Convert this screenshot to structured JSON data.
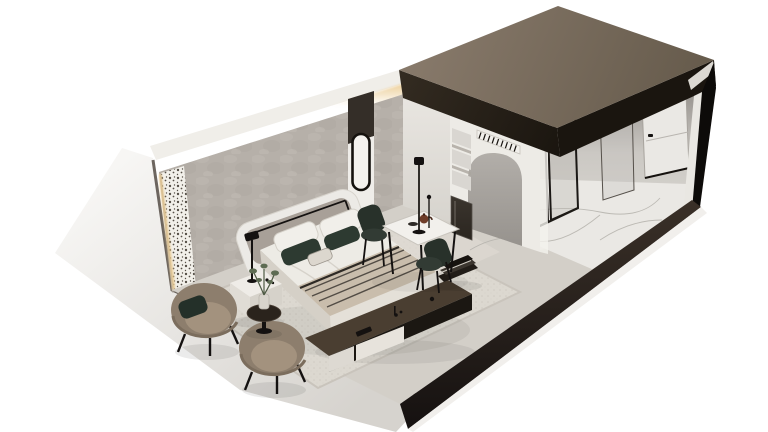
{
  "scene": {
    "kind": "isometric-3d-interior-render",
    "rooms": [
      "bedroom-lounge",
      "dining-nook",
      "entry-corridor",
      "bathroom"
    ],
    "objects": [
      "roof-slab",
      "left-outer-wall",
      "back-wall-wallpaper",
      "led-cove-light",
      "laser-cut-pattern-strip",
      "pilaster-oval-mirror",
      "arched-niche",
      "open-shelving-unit",
      "mini-fridge",
      "vent-grille",
      "double-bed",
      "headboard",
      "pillows",
      "throw-blanket",
      "nightstand",
      "table-lamp",
      "armchair-with-cushion",
      "armchair",
      "round-coffee-table",
      "potted-plant",
      "tv-console",
      "book-stack",
      "dining-table",
      "dining-chairs",
      "floor-lamp",
      "area-rug",
      "marble-floor",
      "entry-door",
      "glass-partition",
      "floor-plinth"
    ]
  },
  "colors": {
    "background": "#ffffff",
    "roof_top": "#87796a",
    "roof_top_shadow": "#655a4b",
    "roof_fascia": "#1a150f",
    "fascia_hilite": "#2e2godine",
    "right_wall": "#0d0b09",
    "wall_trim_white": "#e9e7e2",
    "outer_wall_light": "#f7f6f4",
    "outer_wall_shade": "#d6d3ce",
    "wall_top_band": "#f0eee9",
    "led_glow": "#eac98d",
    "wallpaper": "#b6b0a9",
    "pattern_strip_bg": "#f2f0ea",
    "pattern_motif": "#453e36",
    "wood_panel_dark": "#342e28",
    "pilaster_white": "#efede9",
    "mirror_frame": "#15120e",
    "dining_wall": "#e8e5e0",
    "arch_wall": "#edebe6",
    "arch_recess_light": "#b3afaa",
    "arch_recess_dark": "#94908b",
    "shelf_recess": "#d9d6d1",
    "fridge_dark": "#2b2620",
    "grille_dark": "#17130f",
    "floor_base": "#d3cfc8",
    "rug": "#dcd8d0",
    "marble": "#eae8e4",
    "marble_vein": "#b5b2ac",
    "plinth_top": "#3a3028",
    "plinth": "#151110",
    "floor_edge_white": "#f1efec",
    "interior_wash": "#cbc8c3",
    "bed_duvet": "#edebe5",
    "bed_base": "#e4e0d8",
    "bed_side": "#d5d0c7",
    "throw_blanket": "#c9bdac",
    "throw_stripe": "#46403a",
    "pillow_white": "#f1efea",
    "pillow_green": "#2d3a31",
    "lumbar_pillow": "#dcd7ce",
    "headboard_frame": "#eceae6",
    "headboard_panel": "#a8a098",
    "metal_black": "#141110",
    "nightstand": "#efece7",
    "armchair": "#8d7e6d",
    "armchair_seat": "#a3927e",
    "cushion_green": "#243029",
    "coffee_table": "#2a231c",
    "plant_green": "#5d6b52",
    "plant_stem": "#4e5a44",
    "console_top": "#4a3e31",
    "console_front_dark": "#1b1712",
    "console_front_cream": "#e7e3dc",
    "books": "#221d18",
    "dining_table_top": "#f2f0ec",
    "chair_green": "#28312a",
    "chair_green_seat": "#323b34",
    "door_white": "#eae8e4",
    "glass_tint": "#b9b7b3",
    "frame_dark": "#1d1a16",
    "teapot_brown": "#6e3c28",
    "shadow_soft": "#000000"
  }
}
